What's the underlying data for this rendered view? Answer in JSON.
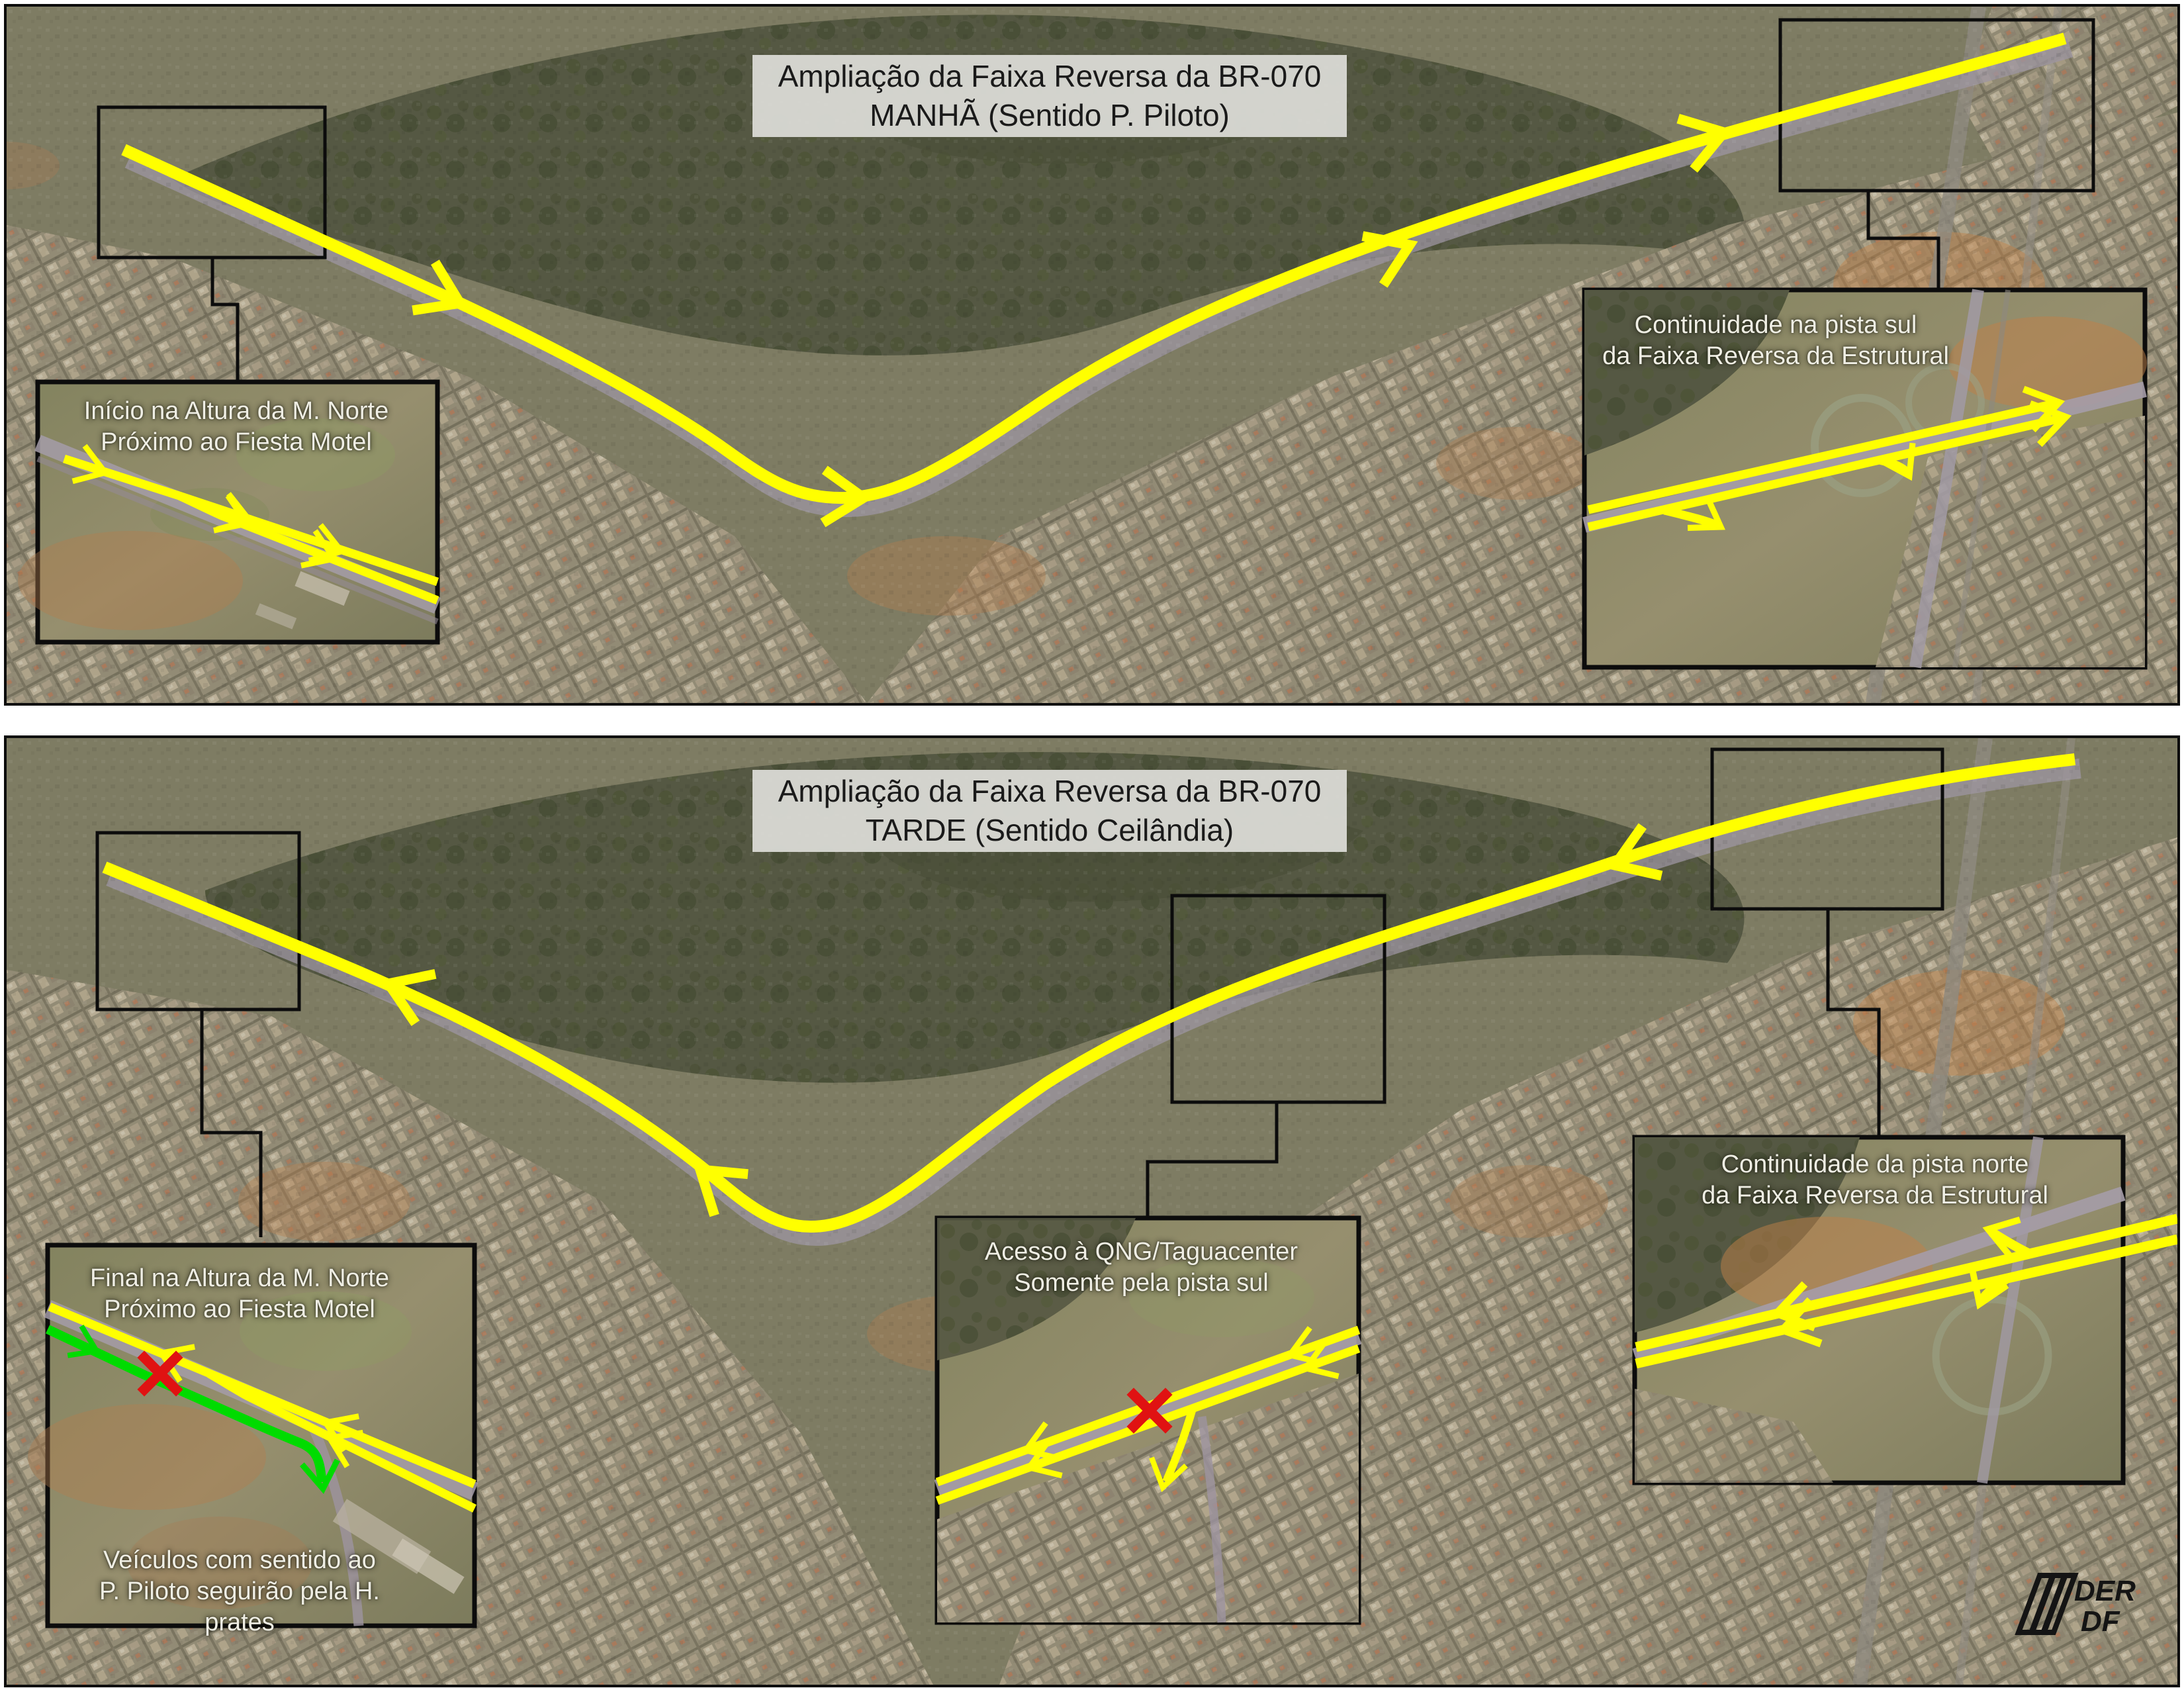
{
  "panels": [
    {
      "name": "manha",
      "title_line1": "Ampliação da Faixa Reversa da BR-070",
      "title_line2": "MANHÃ (Sentido P. Piloto)",
      "insets": [
        {
          "name": "inicio",
          "line1": "Início na Altura da M. Norte",
          "line2": "Próximo ao Fiesta Motel"
        },
        {
          "name": "continuidade-sul",
          "line1": "Continuidade na pista sul",
          "line2": "da Faixa Reversa da Estrutural"
        }
      ]
    },
    {
      "name": "tarde",
      "title_line1": "Ampliação da Faixa Reversa da BR-070",
      "title_line2": "TARDE (Sentido Ceilândia)",
      "insets": [
        {
          "name": "final",
          "line1": "Final na Altura da M. Norte",
          "line2": "Próximo ao Fiesta Motel",
          "bottom1": "Veículos com sentido ao",
          "bottom2": "P. Piloto seguirão pela H. prates"
        },
        {
          "name": "acesso-qng",
          "line1": "Acesso à QNG/Taguacenter",
          "line2": "Somente pela pista sul"
        },
        {
          "name": "continuidade-norte",
          "line1": "Continuidade da pista norte",
          "line2": "da Faixa Reversa da Estrutural"
        }
      ]
    }
  ],
  "logo": {
    "line1": "DER",
    "line2": "DF"
  },
  "colors": {
    "route_yellow": "#FFFF00",
    "detour_green": "#00DB00",
    "closure_red": "#E01212",
    "title_bg": "#DADAD5",
    "title_text": "#1A1A1A",
    "caption_text": "#EFEEE4",
    "outline_black": "#0C0C0C",
    "sat_base": "#7E7C63",
    "sat_forest": "#555843",
    "sat_urban": "#938C76",
    "sat_soil": "#B57E4E",
    "road_gray": "#A19AA5"
  }
}
